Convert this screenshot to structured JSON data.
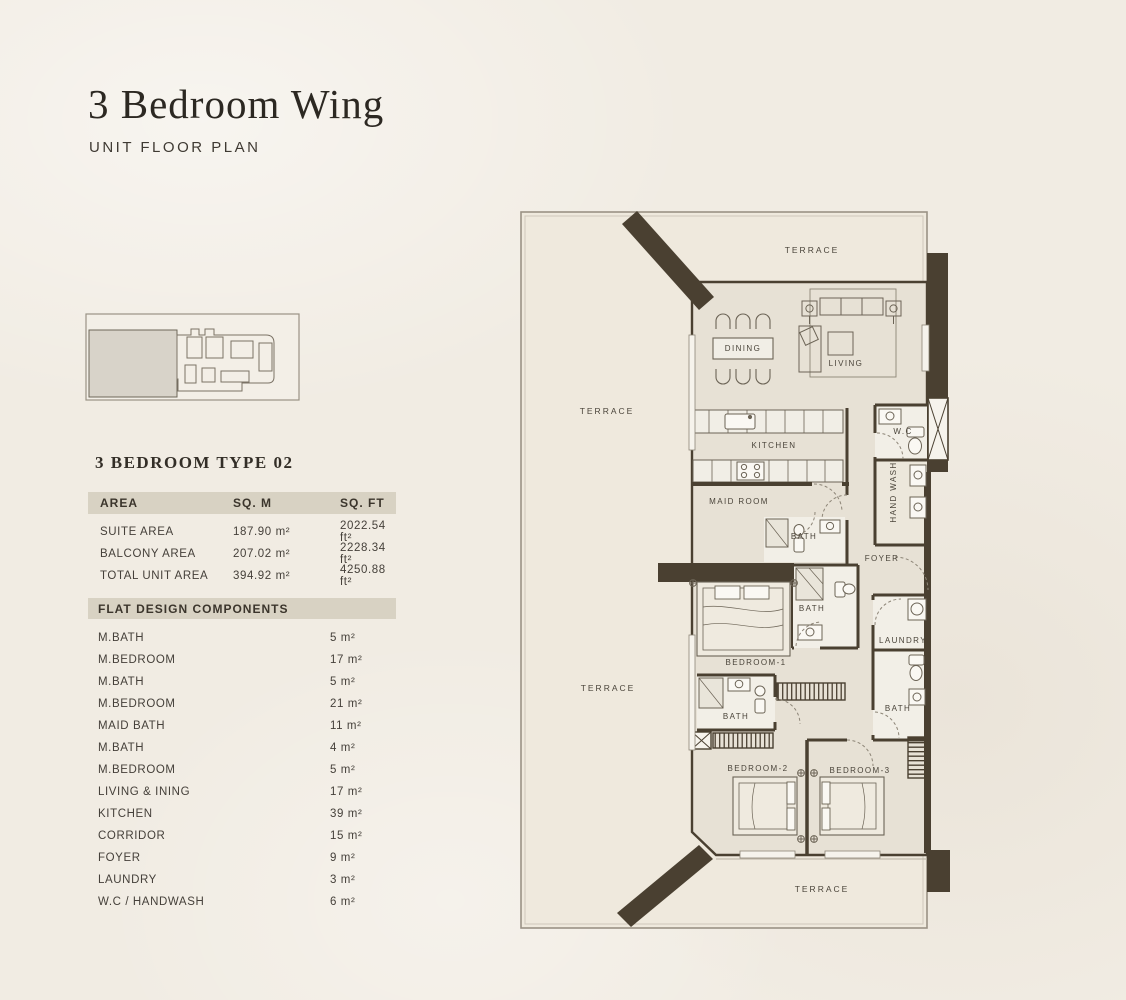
{
  "header": {
    "title": "3 Bedroom Wing",
    "subtitle": "UNIT FLOOR PLAN"
  },
  "unit": {
    "heading": "3 BEDROOM TYPE 02"
  },
  "area_table": {
    "headers": [
      "AREA",
      "SQ. M",
      "SQ. FT"
    ],
    "rows": [
      {
        "label": "SUITE AREA",
        "sqm": "187.90 m²",
        "sqft": "2022.54 ft²"
      },
      {
        "label": "BALCONY AREA",
        "sqm": "207.02 m²",
        "sqft": "2228.34 ft²"
      },
      {
        "label": "TOTAL UNIT AREA",
        "sqm": "394.92 m²",
        "sqft": "4250.88 ft²"
      }
    ]
  },
  "components": {
    "heading": "FLAT DESIGN COMPONENTS",
    "items": [
      {
        "label": "M.BATH",
        "value": "5 m²"
      },
      {
        "label": "M.BEDROOM",
        "value": "17 m²"
      },
      {
        "label": "M.BATH",
        "value": "5 m²"
      },
      {
        "label": "M.BEDROOM",
        "value": "21 m²"
      },
      {
        "label": "MAID BATH",
        "value": "11 m²"
      },
      {
        "label": "M.BATH",
        "value": "4 m²"
      },
      {
        "label": "M.BEDROOM",
        "value": "5 m²"
      },
      {
        "label": "LIVING & INING",
        "value": "17 m²"
      },
      {
        "label": "KITCHEN",
        "value": "39 m²"
      },
      {
        "label": "CORRIDOR",
        "value": "15 m²"
      },
      {
        "label": "FOYER",
        "value": "9 m²"
      },
      {
        "label": "LAUNDRY",
        "value": "3 m²"
      },
      {
        "label": "W.C / HANDWASH",
        "value": "6 m²"
      }
    ]
  },
  "plan": {
    "colors": {
      "wall": "#4a4031",
      "floor": "#e7e1d5",
      "terrace": "#efe9dd"
    },
    "labels": [
      {
        "id": "terrace-top",
        "text": "TERRACE"
      },
      {
        "id": "terrace-left-upper",
        "text": "TERRACE"
      },
      {
        "id": "terrace-left-lower",
        "text": "TERRACE"
      },
      {
        "id": "terrace-bottom",
        "text": "TERRACE"
      },
      {
        "id": "dining",
        "text": "DINING"
      },
      {
        "id": "living",
        "text": "LIVING"
      },
      {
        "id": "kitchen",
        "text": "KITCHEN"
      },
      {
        "id": "maid-room",
        "text": "MAID ROOM"
      },
      {
        "id": "maid-bath",
        "text": "BATH"
      },
      {
        "id": "wc",
        "text": "W.C"
      },
      {
        "id": "hand-wash",
        "text": "HAND WASH"
      },
      {
        "id": "foyer",
        "text": "FOYER"
      },
      {
        "id": "bath-1",
        "text": "BATH"
      },
      {
        "id": "bedroom-1",
        "text": "BEDROOM-1"
      },
      {
        "id": "laundry",
        "text": "LAUNDRY"
      },
      {
        "id": "bath-3",
        "text": "BATH"
      },
      {
        "id": "bath-2",
        "text": "BATH"
      },
      {
        "id": "bedroom-2",
        "text": "BEDROOM-2"
      },
      {
        "id": "bedroom-3",
        "text": "BEDROOM-3"
      }
    ]
  }
}
